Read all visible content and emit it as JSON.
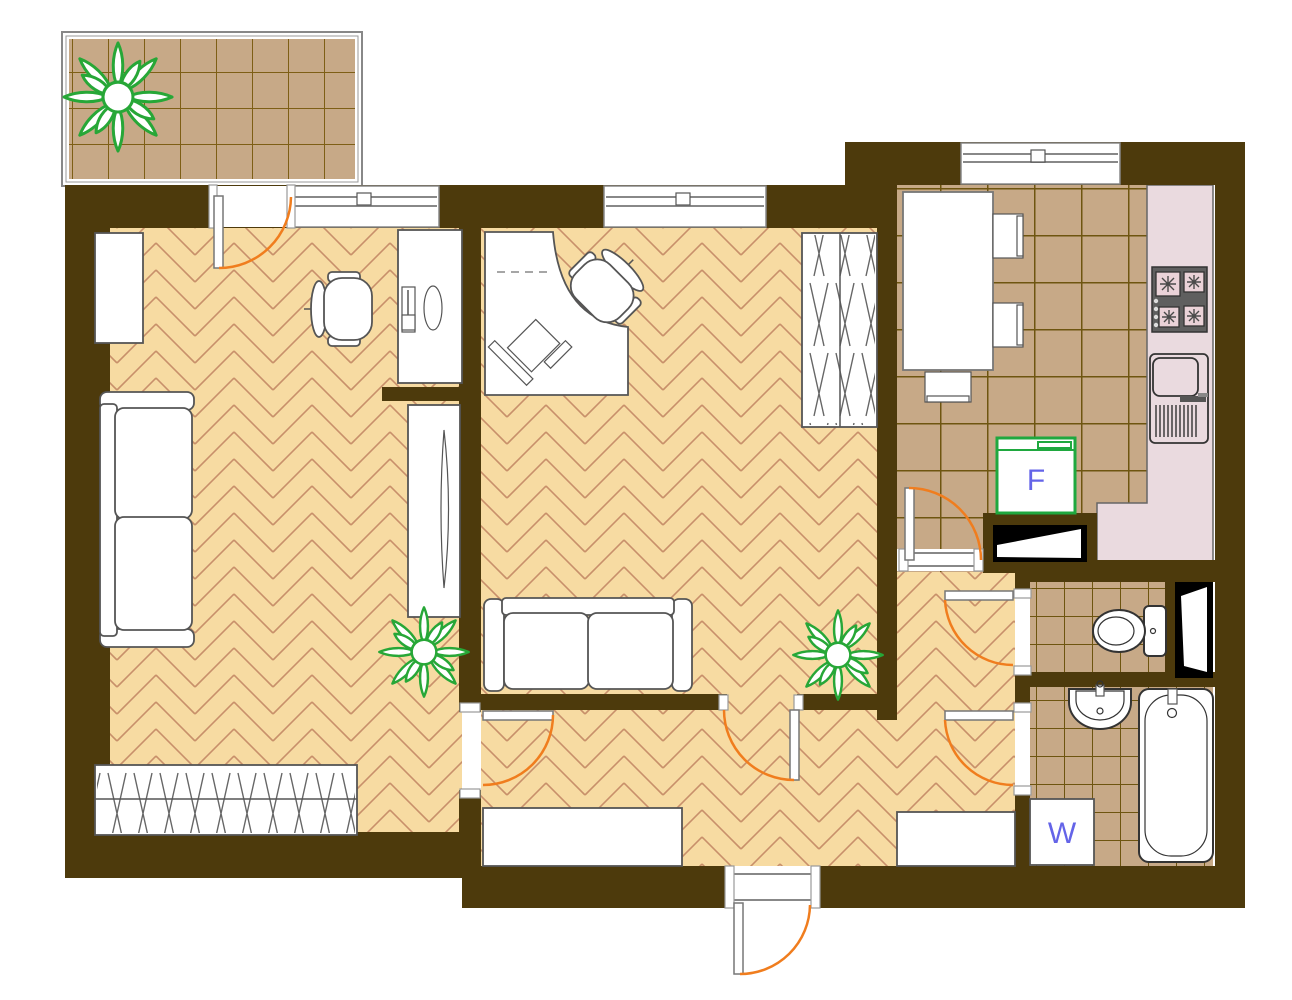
{
  "labels": {
    "fridge": "F",
    "washer": "W"
  },
  "colors": {
    "wall": "#4D3A0C",
    "parquet": "#F7DBA2",
    "parquet-line": "#C8906A",
    "tile": "#C7A987",
    "tile-grout": "#7E5F16",
    "tile-grout-dark": "#6E5510",
    "counter": "#EADADF",
    "stove-body": "#5F5F5F",
    "burner": "#EAD2D8",
    "door-arc": "#F07D1E",
    "plant-green": "#27A737",
    "fixture-green": "#1FA83F",
    "label-blue": "#6464E8",
    "furniture-line": "#555555",
    "frame-line": "#888888",
    "fixture-line": "#333333"
  },
  "fixtures": [
    "balcony",
    "plant",
    "window",
    "door-swing-arc",
    "desk",
    "desktop-computer",
    "office-chair",
    "corner-desk",
    "sofa",
    "tv-cabinet",
    "wardrobe",
    "cabinet",
    "dining-table",
    "dining-chair",
    "countertop",
    "gas-stove",
    "kitchen-sink",
    "fridge",
    "vent-shaft",
    "toilet",
    "washbasin",
    "bathtub",
    "washing-machine",
    "hallway-cabinet",
    "entrance-door"
  ]
}
